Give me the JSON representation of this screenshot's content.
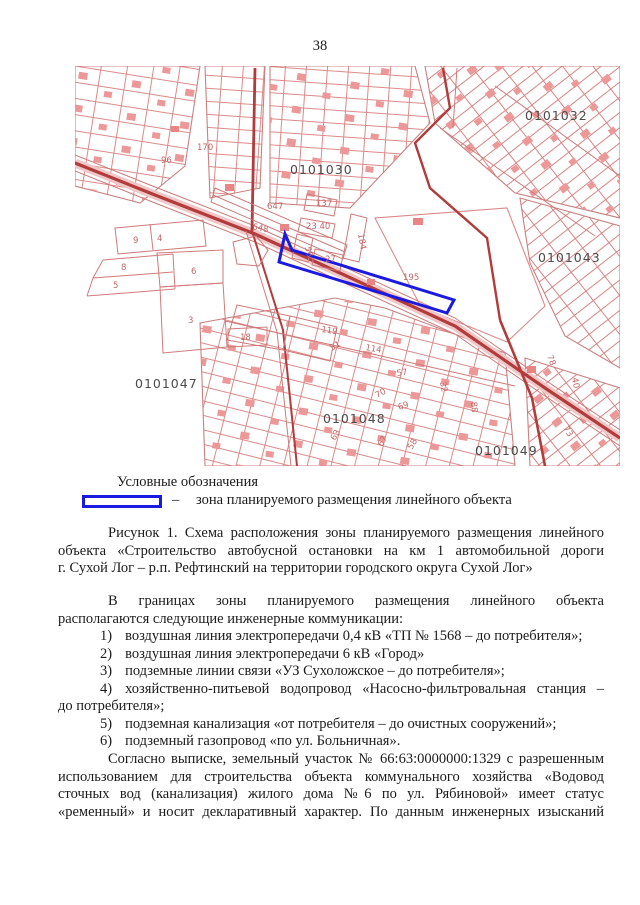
{
  "page": {
    "number": "38"
  },
  "colors": {
    "zone_blue": "#1c1ae0",
    "map_red": "#cf7a7a",
    "map_red_dark": "#b23b3b",
    "quarter_label": "#4b4b4b",
    "text": "#1b1b1b",
    "paper": "#ffffff"
  },
  "map": {
    "description": "cadastral plan with planned linear object zone highlighted in blue",
    "labels": [
      {
        "text": "0101032",
        "x": 450,
        "y": 54,
        "cls": "q"
      },
      {
        "text": "0101030",
        "x": 215,
        "y": 108,
        "cls": "q"
      },
      {
        "text": "0101043",
        "x": 463,
        "y": 196,
        "cls": "q"
      },
      {
        "text": "0101047",
        "x": 60,
        "y": 322,
        "cls": "q"
      },
      {
        "text": "0101048",
        "x": 248,
        "y": 357,
        "cls": "q"
      },
      {
        "text": "0101049",
        "x": 400,
        "y": 389,
        "cls": "q"
      },
      {
        "text": "170",
        "x": 122,
        "y": 84,
        "cls": "p"
      },
      {
        "text": "96",
        "x": 86,
        "y": 97,
        "cls": "p"
      },
      {
        "text": "647",
        "x": 192,
        "y": 143,
        "cls": "p"
      },
      {
        "text": "648",
        "x": 177,
        "y": 163,
        "cls": "p",
        "rot": 12
      },
      {
        "text": "137",
        "x": 241,
        "y": 140,
        "cls": "p"
      },
      {
        "text": "23 40",
        "x": 231,
        "y": 163,
        "cls": "p"
      },
      {
        "text": "56",
        "x": 230,
        "y": 181,
        "cls": "p",
        "rot": 78
      },
      {
        "text": "27",
        "x": 250,
        "y": 196,
        "cls": "p"
      },
      {
        "text": "184",
        "x": 283,
        "y": 168,
        "cls": "p",
        "rot": 80
      },
      {
        "text": "195",
        "x": 328,
        "y": 214,
        "cls": "p"
      },
      {
        "text": "119",
        "x": 246,
        "y": 266,
        "cls": "p",
        "rot": 8
      },
      {
        "text": "114",
        "x": 290,
        "y": 284,
        "cls": "p",
        "rot": 10
      },
      {
        "text": "9",
        "x": 58,
        "y": 177,
        "cls": "p"
      },
      {
        "text": "4",
        "x": 82,
        "y": 175,
        "cls": "p"
      },
      {
        "text": "8",
        "x": 46,
        "y": 204,
        "cls": "p"
      },
      {
        "text": "5",
        "x": 38,
        "y": 222,
        "cls": "p"
      },
      {
        "text": "6",
        "x": 116,
        "y": 208,
        "cls": "p"
      },
      {
        "text": "3",
        "x": 113,
        "y": 257,
        "cls": "p"
      },
      {
        "text": "18",
        "x": 165,
        "y": 274,
        "cls": "p"
      },
      {
        "text": "51",
        "x": 257,
        "y": 285,
        "cls": "p",
        "rot": -32
      },
      {
        "text": "57",
        "x": 322,
        "y": 310,
        "cls": "p",
        "rot": -8
      },
      {
        "text": "70",
        "x": 302,
        "y": 332,
        "cls": "p",
        "rot": -28
      },
      {
        "text": "69",
        "x": 324,
        "y": 344,
        "cls": "p",
        "rot": -18
      },
      {
        "text": "32",
        "x": 365,
        "y": 316,
        "cls": "p",
        "rot": 80
      },
      {
        "text": "88",
        "x": 396,
        "y": 336,
        "cls": "p",
        "rot": 85
      },
      {
        "text": "78",
        "x": 472,
        "y": 290,
        "cls": "p",
        "rot": 70
      },
      {
        "text": "40",
        "x": 497,
        "y": 312,
        "cls": "p",
        "rot": 80
      },
      {
        "text": "73",
        "x": 488,
        "y": 362,
        "cls": "p",
        "rot": 60
      },
      {
        "text": "63",
        "x": 260,
        "y": 375,
        "cls": "p",
        "rot": -60
      },
      {
        "text": "67",
        "x": 307,
        "y": 381,
        "cls": "p",
        "rot": -60
      },
      {
        "text": "58",
        "x": 337,
        "y": 384,
        "cls": "p",
        "rot": -60
      }
    ]
  },
  "legend": {
    "title": "Условные обозначения",
    "dash": "–",
    "item": "зона планируемого размещения линейного объекта"
  },
  "caption": {
    "lines": [
      "Рисунок 1. Схема расположения зоны планируемого размещения линейного",
      "объекта «Строительство автобусной остановки на км 1 автомобильной дороги",
      "г. Сухой Лог – р.п. Рефтинский на территории городского округа Сухой Лог»"
    ]
  },
  "intro": {
    "lines": [
      "В границах зоны планируемого размещения линейного объекта",
      "располагаются следующие инженерные коммуникации:"
    ]
  },
  "items": [
    {
      "marker": "1)",
      "text": "воздушная линия электропередачи 0,4 кВ «ТП № 1568 – до потребителя»;"
    },
    {
      "marker": "2)",
      "text": "воздушная линия электропередачи 6 кВ «Город»"
    },
    {
      "marker": "3)",
      "text": "подземные линии связи «УЗ Сухоложское – до потребителя»;"
    },
    {
      "marker": "4)",
      "text": "хозяйственно-питьевой водопровод «Насосно-фильтровальная станция –",
      "text2": "до потребителя»;"
    },
    {
      "marker": "5)",
      "text": "подземная канализация «от потребителя – до очистных сооружений»;"
    },
    {
      "marker": "6)",
      "text": "подземный газопровод «по ул. Больничная»."
    }
  ],
  "closing": {
    "lines": [
      "Согласно выписке, земельный участок № 66:63:0000000:1329 с разрешенным",
      "использованием для строительства объекта коммунального хозяйства «Водовод",
      "сточных вод (канализация) жилого дома №6 по ул. Рябиновой» имеет статус",
      "«ременный» и носит декларативный характер. По данным инженерных изысканий"
    ]
  }
}
